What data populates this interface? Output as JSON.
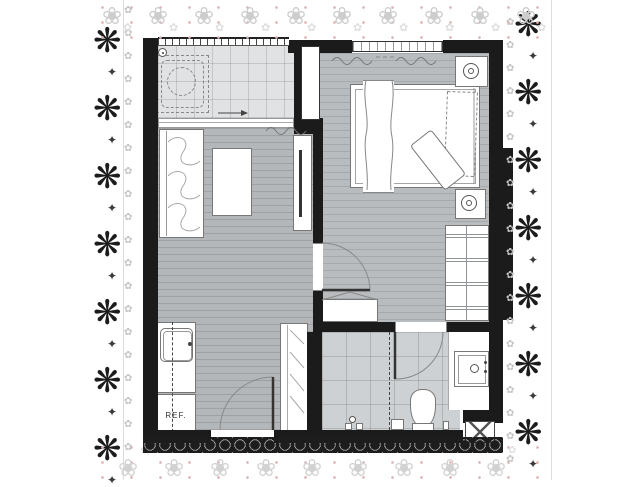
{
  "plan": {
    "fridge_label": "REF.",
    "colors": {
      "wall": "#1b1b1b",
      "floor_wood": "#b4b7b9",
      "floor_wood_bedroom": "#b9bcbe",
      "floor_tile_balcony": "#e1e2e3",
      "floor_tile_bathroom": "#ced1d3",
      "furniture_outline": "#777777",
      "lace_dark": "#1c1c1c",
      "lace_light": "#cdcdcd",
      "lace_pink_dots": "#dbb6b6"
    },
    "icons": {
      "washing_machine": "dashed-drum-circle",
      "floor_drain": "ring-dot",
      "table_lamp": "ring-dot",
      "kitchen_sink": "rounded-square-faucet",
      "vanity_sink": "square-faucet-ring",
      "toilet": "pear-bowl-tank",
      "shower_mixer": "valve-pair",
      "door_swing": "quarter-arc",
      "slide_direction_arrow": "right-arrow",
      "curtain": "wavy-line",
      "shaft_vent": "crossed-box"
    },
    "lace": {
      "dark_glyph": "❋",
      "connector_glyph": "✦",
      "fringe_glyph": "✿",
      "light_glyph": "❀",
      "small_glyph": "✿",
      "left_count": 7,
      "right_count": 7,
      "fringe_count": 20,
      "top_count": 10,
      "bottom_count": 9
    }
  }
}
